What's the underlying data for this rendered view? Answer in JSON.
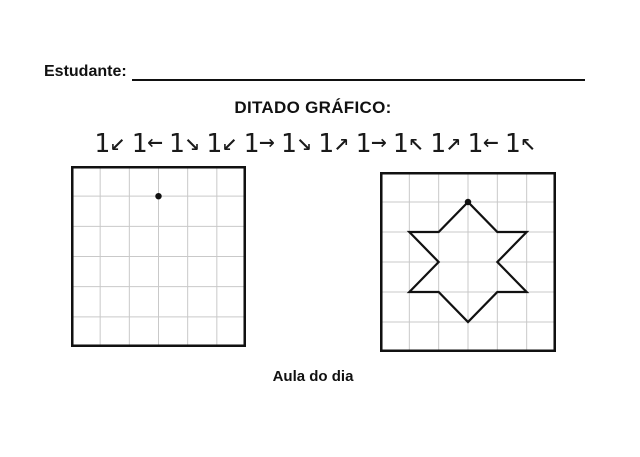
{
  "header": {
    "student_label": "Estudante:",
    "title": "DITADO GRÁFICO:"
  },
  "dictation_sequence": [
    {
      "count": "1",
      "arrow": "↙",
      "direction": "down-left"
    },
    {
      "count": "1",
      "arrow": "←",
      "direction": "left"
    },
    {
      "count": "1",
      "arrow": "↘",
      "direction": "down-right"
    },
    {
      "count": "1",
      "arrow": "↙",
      "direction": "down-left"
    },
    {
      "count": "1",
      "arrow": "→",
      "direction": "right"
    },
    {
      "count": "1",
      "arrow": "↘",
      "direction": "down-right"
    },
    {
      "count": "1",
      "arrow": "↗",
      "direction": "up-right"
    },
    {
      "count": "1",
      "arrow": "→",
      "direction": "right"
    },
    {
      "count": "1",
      "arrow": "↖",
      "direction": "up-left"
    },
    {
      "count": "1",
      "arrow": "↗",
      "direction": "up-right"
    },
    {
      "count": "1",
      "arrow": "←",
      "direction": "left"
    },
    {
      "count": "1",
      "arrow": "↖",
      "direction": "up-left"
    }
  ],
  "grids": {
    "cols": 6,
    "rows": 6,
    "practice": {
      "start_dot": {
        "col": 3,
        "row": 1
      }
    },
    "answer": {
      "start_dot": {
        "col": 3,
        "row": 1
      },
      "star_vertices": [
        [
          3,
          1
        ],
        [
          2,
          2
        ],
        [
          1,
          2
        ],
        [
          2,
          3
        ],
        [
          1,
          4
        ],
        [
          2,
          4
        ],
        [
          3,
          5
        ],
        [
          4,
          4
        ],
        [
          5,
          4
        ],
        [
          4,
          3
        ],
        [
          5,
          2
        ],
        [
          4,
          2
        ]
      ]
    }
  },
  "footer": {
    "label": "Aula do dia"
  },
  "colors": {
    "ink": "#111111",
    "grid_line": "#c9c9c9",
    "background": "#ffffff"
  }
}
